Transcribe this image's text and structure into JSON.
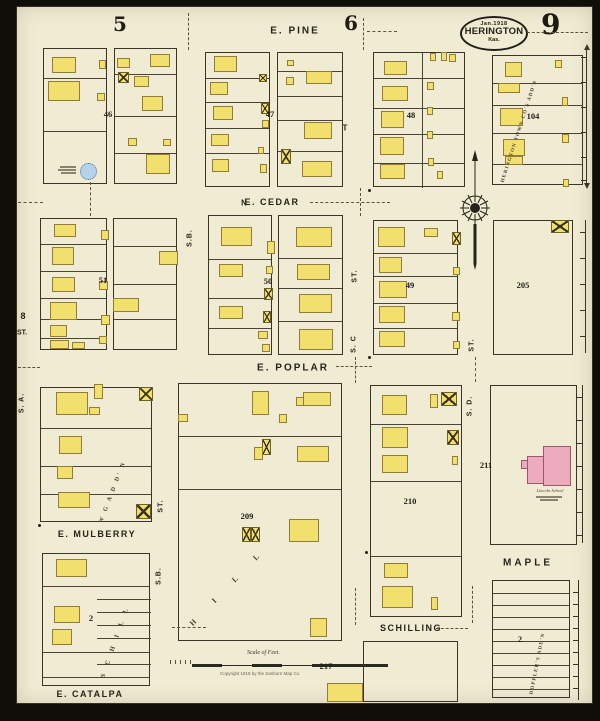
{
  "map": {
    "type": "Sanborn fire insurance map",
    "city": "HERINGTON",
    "state": "Kas.",
    "date": "Jan.1918",
    "sheet_number": "9"
  },
  "school": {
    "name": "Lincoln School"
  },
  "scale": {
    "title": "Scale of Feet.",
    "copyright": "Copyright 1918 by the Sanborn Map Co."
  },
  "street_labels": [
    {
      "t": "E. PINE",
      "x": 295,
      "y": 31,
      "s": 10,
      "ls": 2
    },
    {
      "t": "E. CEDAR",
      "x": 272,
      "y": 202,
      "s": 9,
      "ls": 1.5
    },
    {
      "t": "N",
      "x": 244,
      "y": 203,
      "s": 8,
      "ls": 0
    },
    {
      "t": "E. POPLAR",
      "x": 293,
      "y": 368,
      "s": 10,
      "ls": 2
    },
    {
      "t": "E. MULBERRY",
      "x": 97,
      "y": 534,
      "s": 9,
      "ls": 1.5
    },
    {
      "t": "E. CATALPA",
      "x": 90,
      "y": 694,
      "s": 9,
      "ls": 1.5
    },
    {
      "t": "MAPLE",
      "x": 528,
      "y": 563,
      "s": 10,
      "ls": 3
    },
    {
      "t": "SCHILLING",
      "x": 411,
      "y": 628,
      "s": 9,
      "ls": 1.5
    },
    {
      "t": "S. A.",
      "x": 22,
      "y": 403,
      "s": 7,
      "ls": 1,
      "v": true
    },
    {
      "t": "8",
      "x": 23,
      "y": 316,
      "s": 9,
      "ls": 0
    },
    {
      "t": "ST.",
      "x": 22,
      "y": 333,
      "s": 7,
      "ls": 0
    },
    {
      "t": "S.B.",
      "x": 190,
      "y": 238,
      "s": 7,
      "ls": 1,
      "v": true
    },
    {
      "t": "ST.",
      "x": 355,
      "y": 276,
      "s": 7,
      "ls": 1,
      "v": true
    },
    {
      "t": "S. C",
      "x": 354,
      "y": 344,
      "s": 7,
      "ls": 1,
      "v": true
    },
    {
      "t": "ST.",
      "x": 472,
      "y": 345,
      "s": 7,
      "ls": 1,
      "v": true
    },
    {
      "t": "S. D.",
      "x": 470,
      "y": 406,
      "s": 7,
      "ls": 1,
      "v": true
    },
    {
      "t": "ST.",
      "x": 161,
      "y": 506,
      "s": 7,
      "ls": 1,
      "v": true
    },
    {
      "t": "S.B.",
      "x": 159,
      "y": 576,
      "s": 7,
      "ls": 1,
      "v": true
    },
    {
      "t": "T",
      "x": 345,
      "y": 128,
      "s": 8,
      "ls": 0
    }
  ],
  "big_numbers": [
    {
      "t": "5",
      "x": 120,
      "y": 24,
      "s": 20
    },
    {
      "t": "6",
      "x": 351,
      "y": 23,
      "s": 20
    }
  ],
  "block_numbers": [
    {
      "t": "46",
      "x": 108,
      "y": 114
    },
    {
      "t": "47",
      "x": 270,
      "y": 114
    },
    {
      "t": "48",
      "x": 411,
      "y": 115
    },
    {
      "t": "104",
      "x": 533,
      "y": 116
    },
    {
      "t": "51",
      "x": 103,
      "y": 280
    },
    {
      "t": "50",
      "x": 268,
      "y": 281
    },
    {
      "t": "49",
      "x": 410,
      "y": 285
    },
    {
      "t": "205",
      "x": 523,
      "y": 285
    },
    {
      "t": "209",
      "x": 247,
      "y": 516
    },
    {
      "t": "210",
      "x": 410,
      "y": 501
    },
    {
      "t": "211",
      "x": 486,
      "y": 465
    },
    {
      "t": "217",
      "x": 326,
      "y": 666
    },
    {
      "t": "2",
      "x": 91,
      "y": 618
    },
    {
      "t": "2",
      "x": 520,
      "y": 639
    }
  ],
  "diagonal_labels": [
    {
      "t": "HERINGTON TOWN CO'S ADD'N",
      "x": 503,
      "y": 180,
      "r": -72,
      "s": 5,
      "ls": 1.2
    },
    {
      "t": "W     G     A D D' N",
      "x": 101,
      "y": 520,
      "r": -69,
      "s": 6,
      "ls": 2.5
    },
    {
      "t": "S C H I L L",
      "x": 103,
      "y": 674,
      "r": -71,
      "s": 6.5,
      "ls": 4
    },
    {
      "t": "H I L L",
      "x": 191,
      "y": 620,
      "r": -46,
      "s": 7.5,
      "ls": 12
    },
    {
      "t": "DOPPLER'S   ADD'N",
      "x": 532,
      "y": 692,
      "r": -79,
      "s": 5,
      "ls": 1.2
    }
  ],
  "blocks": [
    {
      "x": 43,
      "y": 48,
      "w": 64,
      "h": 136,
      "hl": [
        77,
        130
      ]
    },
    {
      "x": 114,
      "y": 48,
      "w": 63,
      "h": 136,
      "hl": [
        73,
        115,
        152
      ]
    },
    {
      "x": 205,
      "y": 52,
      "w": 65,
      "h": 135,
      "hl": [
        77,
        101,
        127,
        152
      ]
    },
    {
      "x": 277,
      "y": 52,
      "w": 66,
      "h": 135,
      "hl": [
        70,
        95,
        119,
        150
      ]
    },
    {
      "x": 373,
      "y": 52,
      "w": 92,
      "h": 135,
      "hl": [
        77,
        107,
        133,
        162
      ],
      "vl": [
        [
          421,
          52,
          187
        ]
      ]
    },
    {
      "x": 492,
      "y": 55,
      "w": 91,
      "h": 130,
      "hl": [
        82,
        104,
        132,
        163
      ]
    },
    {
      "x": 40,
      "y": 218,
      "w": 67,
      "h": 132,
      "hl": [
        243,
        270,
        297,
        318,
        337
      ]
    },
    {
      "x": 113,
      "y": 218,
      "w": 64,
      "h": 132,
      "hl": [
        245,
        283,
        318
      ]
    },
    {
      "x": 208,
      "y": 215,
      "w": 64,
      "h": 140,
      "hl": [
        258,
        297,
        327
      ]
    },
    {
      "x": 278,
      "y": 215,
      "w": 65,
      "h": 140,
      "hl": [
        257,
        287,
        320
      ]
    },
    {
      "x": 373,
      "y": 220,
      "w": 85,
      "h": 135,
      "hl": [
        252,
        275,
        302,
        327
      ]
    },
    {
      "x": 493,
      "y": 220,
      "w": 80,
      "h": 135
    },
    {
      "x": 40,
      "y": 387,
      "w": 112,
      "h": 135,
      "hl": [
        427,
        465,
        493
      ]
    },
    {
      "x": 42,
      "y": 553,
      "w": 108,
      "h": 133,
      "hl": [
        585,
        651,
        676
      ],
      "sl": [
        [
          96,
          598,
          150
        ],
        [
          96,
          611,
          150
        ],
        [
          96,
          624,
          150
        ],
        [
          96,
          637,
          150
        ],
        [
          96,
          663,
          150
        ]
      ]
    },
    {
      "x": 178,
      "y": 383,
      "w": 164,
      "h": 258,
      "hl": [
        435,
        488
      ]
    },
    {
      "x": 370,
      "y": 385,
      "w": 92,
      "h": 232,
      "hl": [
        423,
        480,
        555
      ]
    },
    {
      "x": 490,
      "y": 385,
      "w": 87,
      "h": 160
    },
    {
      "x": 363,
      "y": 641,
      "w": 95,
      "h": 61
    },
    {
      "x": 492,
      "y": 580,
      "w": 78,
      "h": 118,
      "hl": [
        592,
        604,
        616,
        628,
        640,
        652,
        664,
        676,
        688
      ]
    }
  ],
  "buildings": [
    [
      52,
      57,
      24,
      16,
      "y"
    ],
    [
      48,
      81,
      32,
      20,
      "y"
    ],
    [
      99,
      60,
      7,
      9,
      "y"
    ],
    [
      97,
      93,
      8,
      8,
      "y"
    ],
    [
      117,
      58,
      13,
      10,
      "y"
    ],
    [
      118,
      72,
      11,
      11,
      "x"
    ],
    [
      134,
      76,
      15,
      11,
      "y"
    ],
    [
      150,
      54,
      20,
      13,
      "y"
    ],
    [
      142,
      96,
      21,
      15,
      "y"
    ],
    [
      128,
      138,
      9,
      8,
      "y"
    ],
    [
      146,
      154,
      24,
      20,
      "y"
    ],
    [
      163,
      139,
      8,
      7,
      "y"
    ],
    [
      214,
      56,
      23,
      16,
      "y"
    ],
    [
      210,
      82,
      18,
      13,
      "y"
    ],
    [
      213,
      106,
      20,
      14,
      "y"
    ],
    [
      211,
      134,
      18,
      12,
      "y"
    ],
    [
      212,
      159,
      17,
      13,
      "y"
    ],
    [
      259,
      74,
      8,
      8,
      "x"
    ],
    [
      261,
      103,
      8,
      11,
      "x"
    ],
    [
      262,
      120,
      7,
      8,
      "y"
    ],
    [
      258,
      147,
      6,
      7,
      "y"
    ],
    [
      260,
      164,
      7,
      9,
      "y"
    ],
    [
      287,
      60,
      7,
      6,
      "y"
    ],
    [
      286,
      77,
      8,
      8,
      "y"
    ],
    [
      306,
      71,
      26,
      13,
      "y"
    ],
    [
      304,
      122,
      28,
      17,
      "y"
    ],
    [
      281,
      149,
      10,
      15,
      "x"
    ],
    [
      302,
      161,
      30,
      16,
      "y"
    ],
    [
      384,
      61,
      23,
      14,
      "y"
    ],
    [
      382,
      86,
      26,
      15,
      "y"
    ],
    [
      381,
      111,
      23,
      17,
      "y"
    ],
    [
      380,
      137,
      24,
      18,
      "y"
    ],
    [
      380,
      164,
      25,
      15,
      "y"
    ],
    [
      427,
      82,
      7,
      8,
      "y"
    ],
    [
      427,
      107,
      6,
      8,
      "y"
    ],
    [
      427,
      131,
      6,
      8,
      "y"
    ],
    [
      428,
      158,
      6,
      8,
      "y"
    ],
    [
      430,
      53,
      6,
      8,
      "y"
    ],
    [
      441,
      52,
      6,
      9,
      "y"
    ],
    [
      449,
      54,
      7,
      8,
      "y"
    ],
    [
      437,
      171,
      6,
      8,
      "y"
    ],
    [
      505,
      62,
      17,
      15,
      "y"
    ],
    [
      498,
      83,
      22,
      10,
      "y"
    ],
    [
      500,
      108,
      23,
      18,
      "y"
    ],
    [
      503,
      139,
      22,
      17,
      "y"
    ],
    [
      505,
      156,
      18,
      9,
      "y"
    ],
    [
      555,
      60,
      7,
      8,
      "y"
    ],
    [
      562,
      97,
      6,
      9,
      "y"
    ],
    [
      562,
      134,
      7,
      9,
      "y"
    ],
    [
      563,
      179,
      6,
      8,
      "y"
    ],
    [
      54,
      224,
      22,
      13,
      "y"
    ],
    [
      52,
      247,
      22,
      18,
      "y"
    ],
    [
      52,
      277,
      23,
      15,
      "y"
    ],
    [
      50,
      302,
      27,
      18,
      "y"
    ],
    [
      50,
      325,
      17,
      12,
      "y"
    ],
    [
      50,
      340,
      19,
      9,
      "y"
    ],
    [
      72,
      342,
      13,
      7,
      "y"
    ],
    [
      101,
      230,
      8,
      10,
      "y"
    ],
    [
      99,
      281,
      9,
      9,
      "y"
    ],
    [
      101,
      315,
      9,
      10,
      "y"
    ],
    [
      99,
      336,
      8,
      8,
      "y"
    ],
    [
      159,
      251,
      19,
      14,
      "y"
    ],
    [
      113,
      298,
      26,
      14,
      "y"
    ],
    [
      221,
      227,
      31,
      19,
      "y"
    ],
    [
      219,
      264,
      24,
      13,
      "y"
    ],
    [
      219,
      306,
      24,
      13,
      "y"
    ],
    [
      267,
      241,
      8,
      13,
      "y"
    ],
    [
      266,
      266,
      7,
      8,
      "y"
    ],
    [
      264,
      288,
      9,
      12,
      "x"
    ],
    [
      263,
      311,
      8,
      12,
      "x"
    ],
    [
      258,
      331,
      10,
      8,
      "y"
    ],
    [
      262,
      344,
      8,
      8,
      "y"
    ],
    [
      296,
      227,
      36,
      20,
      "y"
    ],
    [
      297,
      264,
      33,
      16,
      "y"
    ],
    [
      299,
      294,
      33,
      19,
      "y"
    ],
    [
      299,
      329,
      34,
      21,
      "y"
    ],
    [
      378,
      227,
      27,
      20,
      "y"
    ],
    [
      424,
      228,
      14,
      9,
      "y"
    ],
    [
      379,
      257,
      23,
      16,
      "y"
    ],
    [
      379,
      281,
      28,
      17,
      "y"
    ],
    [
      379,
      306,
      26,
      17,
      "y"
    ],
    [
      379,
      331,
      26,
      16,
      "y"
    ],
    [
      452,
      232,
      9,
      13,
      "x"
    ],
    [
      453,
      267,
      7,
      8,
      "y"
    ],
    [
      452,
      312,
      8,
      9,
      "y"
    ],
    [
      453,
      341,
      7,
      8,
      "y"
    ],
    [
      551,
      220,
      18,
      13,
      "x"
    ],
    [
      56,
      392,
      32,
      23,
      "y"
    ],
    [
      89,
      407,
      11,
      8,
      "y"
    ],
    [
      94,
      384,
      9,
      15,
      "y"
    ],
    [
      59,
      436,
      23,
      18,
      "y"
    ],
    [
      57,
      466,
      16,
      13,
      "y"
    ],
    [
      58,
      492,
      32,
      16,
      "y"
    ],
    [
      139,
      387,
      14,
      14,
      "x"
    ],
    [
      136,
      504,
      15,
      15,
      "x"
    ],
    [
      56,
      559,
      31,
      18,
      "y"
    ],
    [
      54,
      606,
      26,
      17,
      "y"
    ],
    [
      52,
      629,
      20,
      16,
      "y"
    ],
    [
      252,
      391,
      17,
      24,
      "y"
    ],
    [
      296,
      397,
      8,
      9,
      "y"
    ],
    [
      303,
      392,
      28,
      14,
      "y"
    ],
    [
      279,
      414,
      8,
      9,
      "y"
    ],
    [
      178,
      414,
      10,
      8,
      "y"
    ],
    [
      262,
      439,
      9,
      16,
      "x"
    ],
    [
      254,
      447,
      9,
      13,
      "y"
    ],
    [
      297,
      446,
      32,
      16,
      "y"
    ],
    [
      242,
      527,
      9,
      15,
      "x"
    ],
    [
      251,
      527,
      9,
      15,
      "x"
    ],
    [
      289,
      519,
      30,
      23,
      "y"
    ],
    [
      310,
      618,
      17,
      19,
      "y"
    ],
    [
      327,
      683,
      36,
      19,
      "y"
    ],
    [
      382,
      395,
      25,
      20,
      "y"
    ],
    [
      430,
      394,
      8,
      14,
      "y"
    ],
    [
      441,
      392,
      16,
      14,
      "x"
    ],
    [
      382,
      427,
      26,
      21,
      "y"
    ],
    [
      447,
      430,
      12,
      15,
      "x"
    ],
    [
      382,
      455,
      26,
      18,
      "y"
    ],
    [
      452,
      456,
      6,
      9,
      "y"
    ],
    [
      384,
      563,
      24,
      15,
      "y"
    ],
    [
      382,
      586,
      31,
      22,
      "y"
    ],
    [
      431,
      597,
      7,
      13,
      "y"
    ],
    [
      527,
      456,
      18,
      28,
      "p"
    ],
    [
      543,
      446,
      28,
      40,
      "p"
    ],
    [
      521,
      460,
      7,
      9,
      "p"
    ]
  ],
  "water_tank": {
    "x": 80,
    "y": 163,
    "d": 17
  },
  "dashes": [
    [
      367,
      31,
      397,
      31
    ],
    [
      527,
      32,
      588,
      32
    ],
    [
      310,
      202,
      390,
      202
    ],
    [
      18,
      202,
      43,
      202
    ],
    [
      336,
      366,
      372,
      366
    ],
    [
      18,
      367,
      40,
      367
    ],
    [
      172,
      627,
      206,
      627
    ],
    [
      436,
      628,
      468,
      628
    ],
    [
      188,
      13,
      188,
      50
    ],
    [
      363,
      18,
      363,
      50
    ],
    [
      90,
      182,
      90,
      216
    ],
    [
      360,
      188,
      360,
      216
    ],
    [
      355,
      357,
      355,
      383
    ],
    [
      475,
      357,
      475,
      382
    ],
    [
      355,
      588,
      355,
      625
    ],
    [
      472,
      586,
      472,
      623
    ]
  ],
  "edge_lines": [
    {
      "x": 586,
      "y1": 50,
      "y2": 183,
      "ticks": [
        57,
        82,
        107,
        132,
        157,
        180
      ],
      "arrows": true
    },
    {
      "x": 585,
      "y1": 220,
      "y2": 353,
      "ticks": [
        232,
        258,
        284,
        310,
        336
      ]
    },
    {
      "x": 582,
      "y1": 385,
      "y2": 543,
      "ticks": [
        397,
        420,
        443,
        466,
        489,
        512,
        535
      ]
    },
    {
      "x": 578,
      "y1": 580,
      "y2": 700,
      "ticks": [
        592,
        604,
        616,
        628,
        640,
        652,
        664,
        676,
        688
      ]
    }
  ],
  "dots": [
    [
      368,
      189
    ],
    [
      368,
      356
    ],
    [
      38,
      524
    ],
    [
      365,
      551
    ]
  ]
}
